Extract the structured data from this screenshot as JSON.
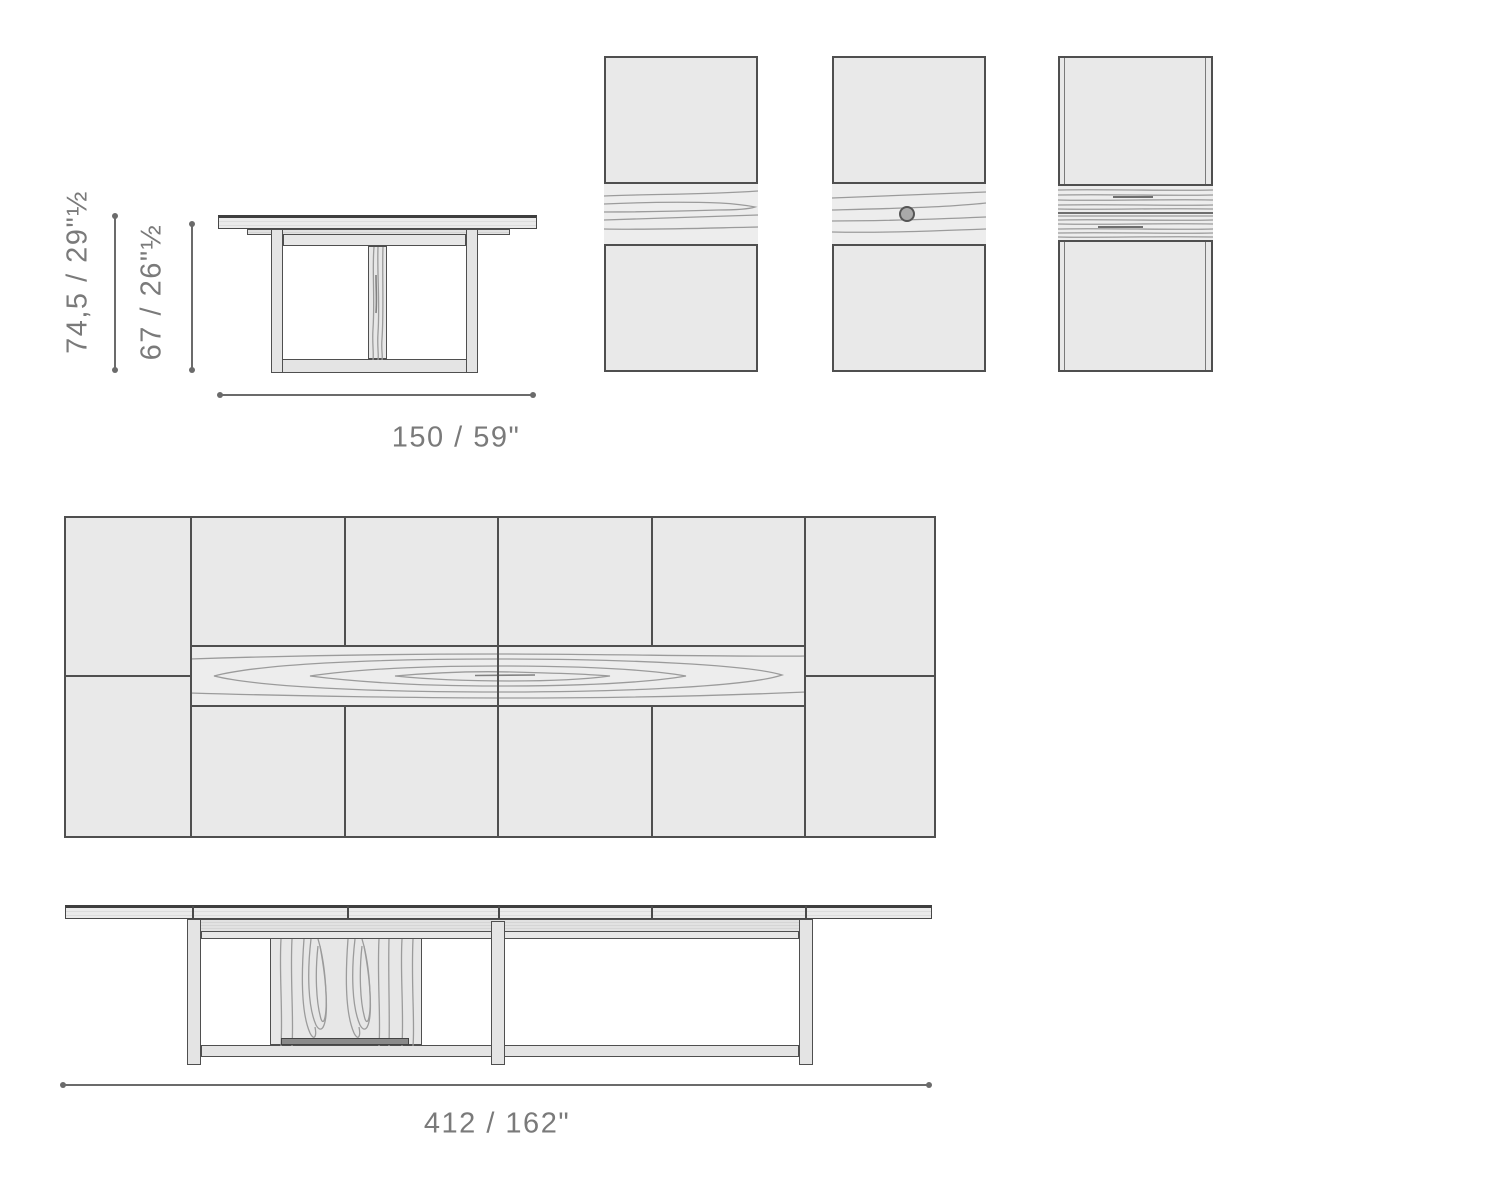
{
  "labels": {
    "front_height_total": "74,5 / 29\"½",
    "front_height_clearance": "67 / 26\"½",
    "front_width": "150 / 59\"",
    "side_length": "412 / 162\""
  },
  "colors": {
    "outline": "#4f4f4f",
    "panel_fill": "#e9e9e9",
    "band_fill": "#ededed",
    "grain": "#9b9b9b",
    "dim_line": "#6b6b6b",
    "dimension_text": "#7a7a7a",
    "knot_fill": "#a9a9a9"
  }
}
